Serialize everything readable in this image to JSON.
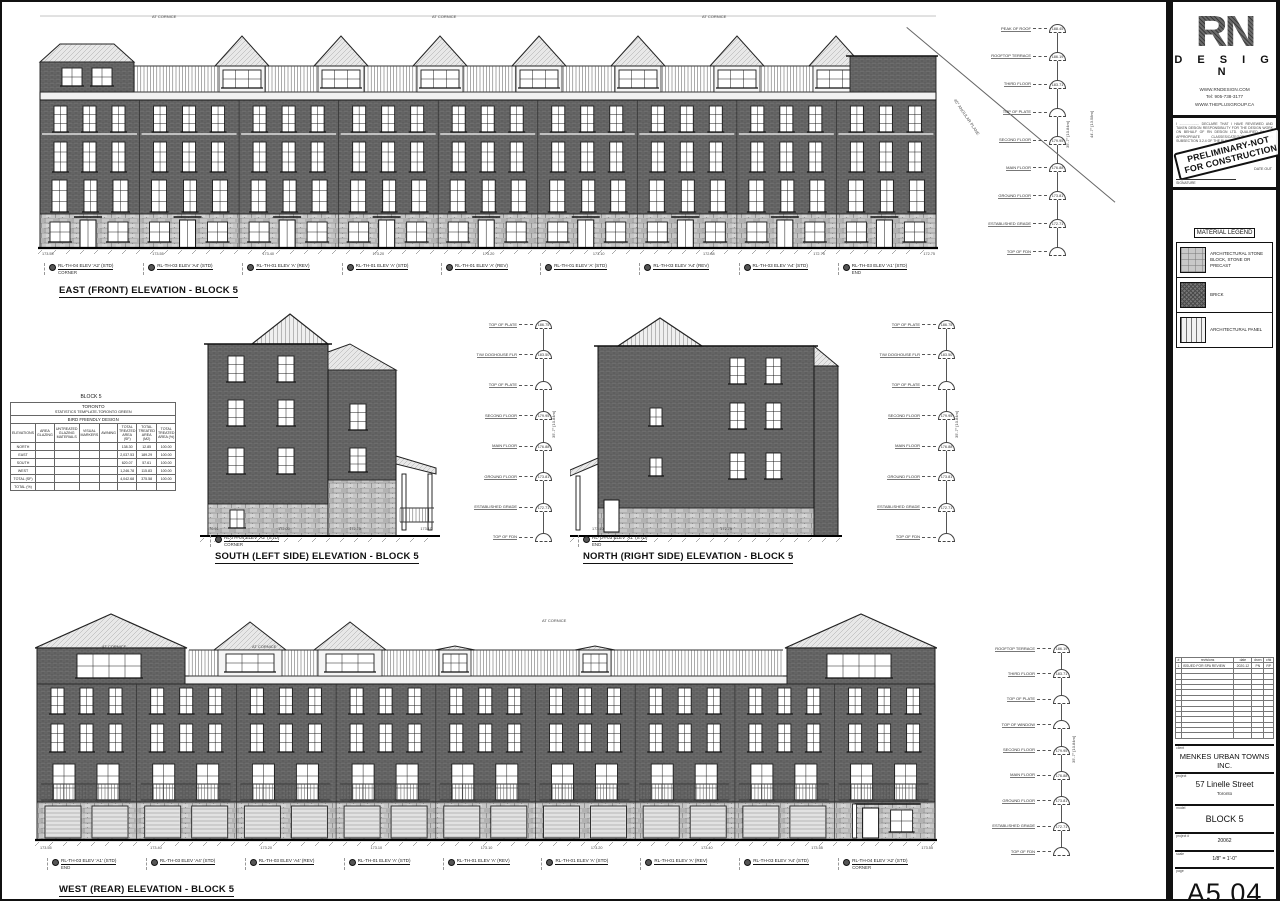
{
  "angular_plane_note": "45° ANGULAR PLANE",
  "elevations": {
    "east": {
      "title": "EAST (FRONT) ELEVATION - BLOCK 5",
      "keynotes": [
        {
          "label": "RL-TH-04 ELEV 'A2' (STD)",
          "sub": "CORNER"
        },
        {
          "label": "RL-TH-03 ELEV 'A4' (STD)",
          "sub": ""
        },
        {
          "label": "RL-TH-01 ELEV 'A' (REV)",
          "sub": ""
        },
        {
          "label": "RL-TH-01 ELEV 'A' (STD)",
          "sub": ""
        },
        {
          "label": "RL-TH-01 ELEV 'A' (REV)",
          "sub": ""
        },
        {
          "label": "RL-TH-01 ELEV 'A' (STD)",
          "sub": ""
        },
        {
          "label": "RL-TH-03 ELEV 'A4' (REV)",
          "sub": ""
        },
        {
          "label": "RL-TH-03 ELEV 'A4' (STD)",
          "sub": ""
        },
        {
          "label": "RL-TH-03 ELEV 'A1' (STD)",
          "sub": "END"
        }
      ],
      "levels": [
        {
          "name": "PEAK OF ROOF",
          "value": "188.45"
        },
        {
          "name": "ROOFTOP TERRACE",
          "value": "186.19"
        },
        {
          "name": "THIRD FLOOR",
          "value": "183.71"
        },
        {
          "name": "TOP OF PLATE",
          "value": ""
        },
        {
          "name": "SECOND FLOOR",
          "value": "179.95"
        },
        {
          "name": "MAIN FLOOR",
          "value": "176.88"
        },
        {
          "name": "GROUND FLOOR",
          "value": "173.81"
        },
        {
          "name": "ESTABLISHED GRADE",
          "value": "172.71"
        },
        {
          "name": "TOP OF FDN",
          "value": ""
        }
      ],
      "dim_overall": "35'-7\" [10.84m]",
      "dim_total": "44'-7\" [13.58m]",
      "base_grades": [
        "173.55",
        "173.55",
        "173.40",
        "173.20",
        "173.20",
        "173.10",
        "172.88",
        "172.75",
        "172.75"
      ],
      "roof_notes": [
        "AT CORNICE",
        "AT CORNICE",
        "AT CORNICE"
      ]
    },
    "south": {
      "title": "SOUTH (LEFT SIDE) ELEVATION - BLOCK 5",
      "keynotes": [
        {
          "label": "RL-TH-04 ELEV 'A2' (STD)",
          "sub": "CORNER"
        }
      ],
      "levels": [
        {
          "name": "TOP OF PLATE",
          "value": "186.75"
        },
        {
          "name": "T/W DOGHOUSE FLR",
          "value": "183.50"
        },
        {
          "name": "TOP OF PLATE",
          "value": ""
        },
        {
          "name": "SECOND FLOOR",
          "value": "179.95"
        },
        {
          "name": "MAIN FLOOR",
          "value": "176.88"
        },
        {
          "name": "GROUND FLOOR",
          "value": "173.81"
        },
        {
          "name": "ESTABLISHED GRADE",
          "value": "172.71"
        },
        {
          "name": "TOP OF FDN",
          "value": ""
        }
      ],
      "dim_overall": "35'-7\" [10.84m]",
      "base_grades": [
        "170.91",
        "172.00",
        "172.75",
        "173.10"
      ]
    },
    "north": {
      "title": "NORTH (RIGHT SIDE) ELEVATION - BLOCK 5",
      "keynotes": [
        {
          "label": "RL-TH-03 ELEV 'A1' (STD)",
          "sub": "END"
        }
      ],
      "levels": [
        {
          "name": "TOP OF PLATE",
          "value": "186.75"
        },
        {
          "name": "T/W DOGHOUSE FLR",
          "value": "183.50"
        },
        {
          "name": "TOP OF PLATE",
          "value": ""
        },
        {
          "name": "SECOND FLOOR",
          "value": "179.95"
        },
        {
          "name": "MAIN FLOOR",
          "value": "176.88"
        },
        {
          "name": "GROUND FLOOR",
          "value": "173.81"
        },
        {
          "name": "ESTABLISHED GRADE",
          "value": "172.71"
        },
        {
          "name": "TOP OF FDN",
          "value": ""
        }
      ],
      "dim_overall": "35'-7\" [10.84m]",
      "base_grades": [
        "173.10",
        "172.75"
      ]
    },
    "west": {
      "title": "WEST (REAR) ELEVATION - BLOCK 5",
      "keynotes": [
        {
          "label": "RL-TH-03 ELEV 'A1' (STD)",
          "sub": "END"
        },
        {
          "label": "RL-TH-03 ELEV 'A4' (STD)",
          "sub": ""
        },
        {
          "label": "RL-TH-03 ELEV 'A4' (REV)",
          "sub": ""
        },
        {
          "label": "RL-TH-01 ELEV 'A' (STD)",
          "sub": ""
        },
        {
          "label": "RL-TH-01 ELEV 'A' (REV)",
          "sub": ""
        },
        {
          "label": "RL-TH-01 ELEV 'A' (STD)",
          "sub": ""
        },
        {
          "label": "RL-TH-01 ELEV 'A' (REV)",
          "sub": ""
        },
        {
          "label": "RL-TH-03 ELEV 'A4' (STD)",
          "sub": ""
        },
        {
          "label": "RL-TH-04 ELEV 'A2' (STD)",
          "sub": "CORNER"
        }
      ],
      "levels": [
        {
          "name": "ROOFTOP TERRACE",
          "value": "186.19"
        },
        {
          "name": "THIRD FLOOR",
          "value": "183.71"
        },
        {
          "name": "TOP OF PLATE",
          "value": ""
        },
        {
          "name": "TOP OF WINDOW",
          "value": ""
        },
        {
          "name": "SECOND FLOOR",
          "value": "179.95"
        },
        {
          "name": "MAIN FLOOR",
          "value": "176.88"
        },
        {
          "name": "GROUND FLOOR",
          "value": "173.81"
        },
        {
          "name": "ESTABLISHED GRADE",
          "value": "172.71"
        },
        {
          "name": "TOP OF FDN",
          "value": ""
        }
      ],
      "dim_overall": "35'-7\" [10.84m]",
      "base_grades": [
        "173.55",
        "173.40",
        "173.20",
        "173.10",
        "173.10",
        "173.20",
        "173.40",
        "173.55",
        "173.55"
      ],
      "roof_notes": [
        "AT CORNICE",
        "AT CORNICE",
        "AT CORNICE"
      ]
    }
  },
  "stats_table": {
    "block_title": "BLOCK 5",
    "header_city": "TORONTO",
    "header_template": "STATISTICS TEMPLATE-TORONTO GREEN",
    "header_program": "BIRD FRIENDLY DESIGN",
    "columns": [
      "ELEVATIONS",
      "AREA GLAZING",
      "UNTREATED GLAZING MATERIALS",
      "VISUAL MARKERS",
      "AWNING",
      "TOTAL TREATED AREA (SF)",
      "TOTAL TREATED AREA (M2)",
      "TOTAL TREATED AREA (%)"
    ],
    "rows": [
      {
        "cells": [
          "NORTH",
          "",
          "",
          "",
          "",
          "138.30",
          "12.85",
          "100.00"
        ]
      },
      {
        "cells": [
          "EAST",
          "",
          "",
          "",
          "",
          "2,037.53",
          "189.29",
          "100.00"
        ]
      },
      {
        "cells": [
          "SOUTH",
          "",
          "",
          "",
          "",
          "620.07",
          "57.61",
          "100.00"
        ]
      },
      {
        "cells": [
          "WEST",
          "",
          "",
          "",
          "",
          "1,246.78",
          "115.83",
          "100.00"
        ]
      },
      {
        "cells": [
          "TOTAL (SF)",
          "",
          "",
          "",
          "",
          "4,042.68",
          "375.58",
          "100.00"
        ]
      },
      {
        "cells": [
          "TOTAL (%)",
          "",
          "",
          "",
          "",
          "",
          "",
          ""
        ]
      }
    ]
  },
  "titleblock": {
    "logo_rn": "RN",
    "logo_design": "D E S I G N",
    "contact": [
      "WWW.RNDESIGN.COM",
      "Tel: 905-738-3177",
      "WWW.THEPLUSGROUP.CA"
    ],
    "declaration": "I ..................... DECLARE THAT I HAVE REVIEWED AND TAKEN DESIGN RESPONSIBILITY FOR THE DESIGN WORK ON BEHALF OF RN DESIGN LTD. QUALIFIED IN THE APPROPRIATE CLASSES/CATEGORIES UNDER SUBSECTION 3.2.4 OF THE BUILDING CODE. FIRM BCIN:",
    "stamp_line1": "PRELIMINARY-NOT",
    "stamp_line2": "FOR CONSTRUCTION",
    "date_out_label": "DATE OUT",
    "signature_label": "SIGNATURE",
    "legend": {
      "title": "MATERIAL LEGEND",
      "items": [
        {
          "label": "ARCHITECTURAL STONE BLOCK, STONE OR PRECAST",
          "swatch": "stone-swatch"
        },
        {
          "label": "BRICK",
          "swatch": "brick-swatch"
        },
        {
          "label": "ARCHITECTURAL PANEL",
          "swatch": "panel-swatch"
        }
      ]
    },
    "revisions": {
      "headers": [
        "#",
        "revisions",
        "date",
        "drwn",
        "chk"
      ],
      "row1": {
        "num": "1",
        "desc": "ISSUED FOR SPA REVIEW",
        "date": "2020-12",
        "drwn": "PN",
        "chk": "RP"
      }
    },
    "client_label": "client",
    "client": "MENKES URBAN TOWNS INC.",
    "project_label": "project",
    "project": "57 Linelle Street",
    "project_city": "Toronto",
    "model_label": "model",
    "model": "BLOCK 5",
    "project_no_label": "project #",
    "project_no": "20062",
    "scale_label": "scale",
    "scale": "1/8\" = 1'-0\"",
    "page_label": "page",
    "page": "A5 04"
  }
}
